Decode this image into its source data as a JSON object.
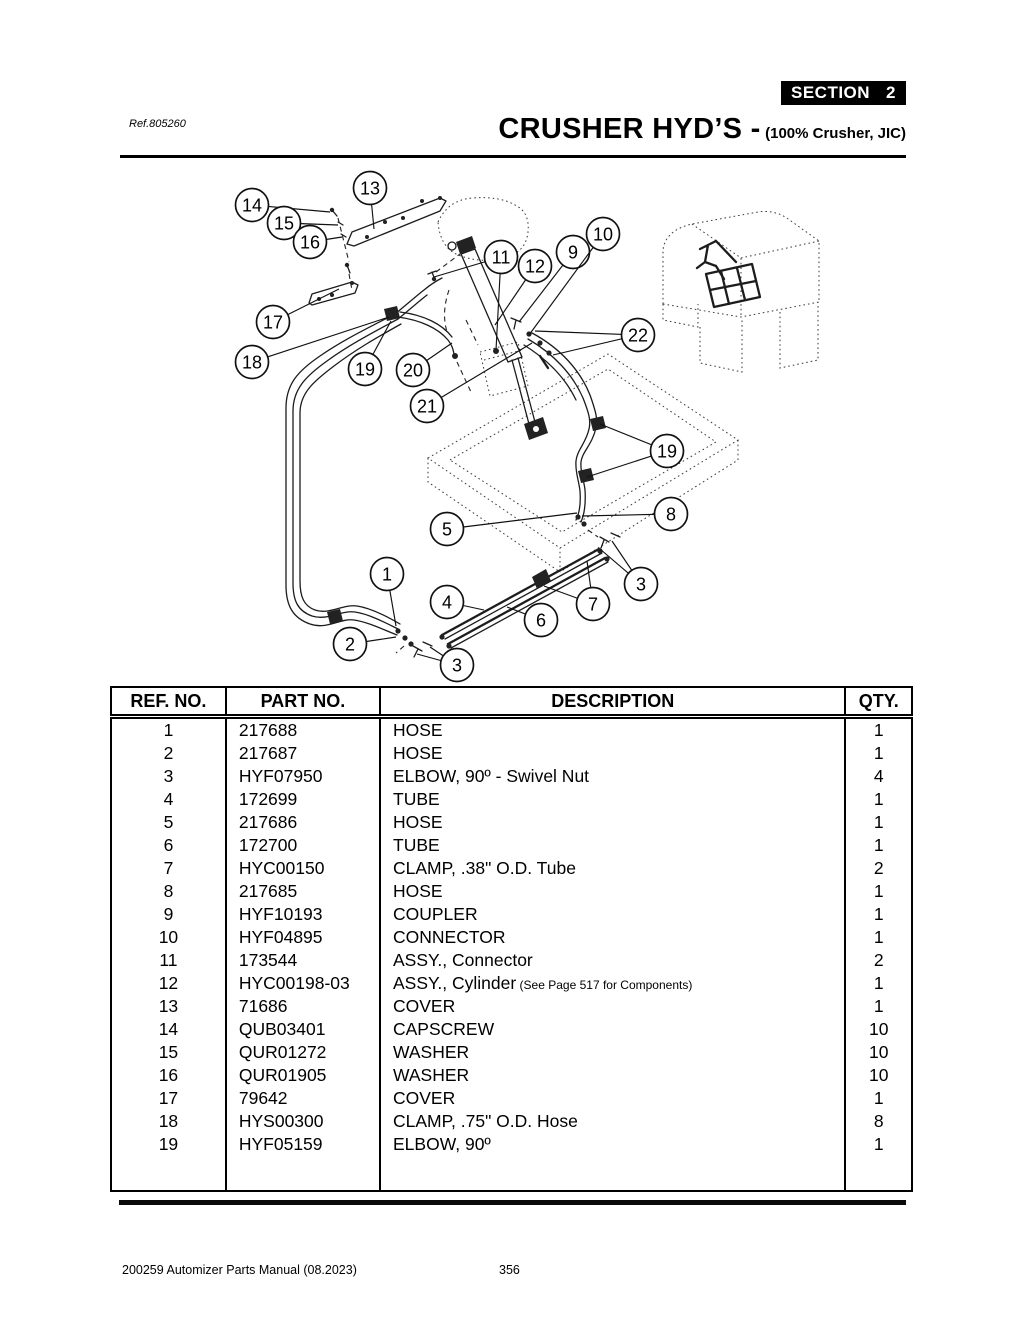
{
  "page": {
    "section_label": "SECTION",
    "section_number": "2",
    "ref_label": "Ref.805260",
    "title": "CRUSHER HYD’S -",
    "subtitle": "(100% Crusher, JIC)"
  },
  "table": {
    "headers": [
      "REF. NO.",
      "PART NO.",
      "DESCRIPTION",
      "QTY."
    ],
    "rows": [
      {
        "ref": "1",
        "part": "217688",
        "desc": "HOSE",
        "note": "",
        "qty": "1"
      },
      {
        "ref": "2",
        "part": "217687",
        "desc": "HOSE",
        "note": "",
        "qty": "1"
      },
      {
        "ref": "3",
        "part": "HYF07950",
        "desc": "ELBOW, 90º - Swivel Nut",
        "note": "",
        "qty": "4"
      },
      {
        "ref": "4",
        "part": "172699",
        "desc": "TUBE",
        "note": "",
        "qty": "1"
      },
      {
        "ref": "5",
        "part": "217686",
        "desc": "HOSE",
        "note": "",
        "qty": "1"
      },
      {
        "ref": "6",
        "part": "172700",
        "desc": "TUBE",
        "note": "",
        "qty": "1"
      },
      {
        "ref": "7",
        "part": "HYC00150",
        "desc": "CLAMP, .38\" O.D. Tube",
        "note": "",
        "qty": "2"
      },
      {
        "ref": "8",
        "part": "217685",
        "desc": "HOSE",
        "note": "",
        "qty": "1"
      },
      {
        "ref": "9",
        "part": "HYF10193",
        "desc": "COUPLER",
        "note": "",
        "qty": "1"
      },
      {
        "ref": "10",
        "part": "HYF04895",
        "desc": "CONNECTOR",
        "note": "",
        "qty": "1"
      },
      {
        "ref": "11",
        "part": "173544",
        "desc": "ASSY., Connector",
        "note": "",
        "qty": "2"
      },
      {
        "ref": "12",
        "part": "HYC00198-03",
        "desc": "ASSY., Cylinder",
        "note": "(See Page 517 for Components)",
        "qty": "1"
      },
      {
        "ref": "13",
        "part": "71686",
        "desc": "COVER",
        "note": "",
        "qty": "1"
      },
      {
        "ref": "14",
        "part": "QUB03401",
        "desc": "CAPSCREW",
        "note": "",
        "qty": "10"
      },
      {
        "ref": "15",
        "part": "QUR01272",
        "desc": "WASHER",
        "note": "",
        "qty": "10"
      },
      {
        "ref": "16",
        "part": "QUR01905",
        "desc": "WASHER",
        "note": "",
        "qty": "10"
      },
      {
        "ref": "17",
        "part": "79642",
        "desc": "COVER",
        "note": "",
        "qty": "1"
      },
      {
        "ref": "18",
        "part": "HYS00300",
        "desc": "CLAMP, .75\" O.D. Hose",
        "note": "",
        "qty": "8"
      },
      {
        "ref": "19",
        "part": "HYF05159",
        "desc": "ELBOW, 90º",
        "note": "",
        "qty": "1"
      }
    ]
  },
  "diagram": {
    "callouts": [
      {
        "label": "1",
        "x": 387,
        "y": 574,
        "leaders": [
          [
            396,
            626
          ]
        ]
      },
      {
        "label": "2",
        "x": 350,
        "y": 644,
        "leaders": [
          [
            396,
            637
          ]
        ]
      },
      {
        "label": "3",
        "x": 457,
        "y": 665,
        "leaders": [
          [
            430,
            647
          ],
          [
            417,
            654
          ]
        ]
      },
      {
        "label": "3",
        "x": 641,
        "y": 584,
        "leaders": [
          [
            612,
            541
          ],
          [
            600,
            549
          ]
        ]
      },
      {
        "label": "4",
        "x": 447,
        "y": 602,
        "leaders": [
          [
            484,
            610
          ]
        ]
      },
      {
        "label": "5",
        "x": 447,
        "y": 529,
        "leaders": [
          [
            577,
            513
          ]
        ]
      },
      {
        "label": "6",
        "x": 541,
        "y": 620,
        "leaders": [
          [
            507,
            607
          ]
        ]
      },
      {
        "label": "7",
        "x": 593,
        "y": 604,
        "leaders": [
          [
            544,
            586
          ],
          [
            587,
            561
          ]
        ]
      },
      {
        "label": "8",
        "x": 671,
        "y": 514,
        "leaders": [
          [
            582,
            516
          ]
        ]
      },
      {
        "label": "9",
        "x": 573,
        "y": 252,
        "leaders": [
          [
            519,
            322
          ]
        ]
      },
      {
        "label": "10",
        "x": 603,
        "y": 234,
        "leaders": [
          [
            529,
            335
          ]
        ]
      },
      {
        "label": "11",
        "x": 501,
        "y": 257,
        "leaders": [
          [
            434,
            277
          ],
          [
            496,
            350
          ]
        ]
      },
      {
        "label": "12",
        "x": 535,
        "y": 266,
        "leaders": [
          [
            495,
            325
          ]
        ]
      },
      {
        "label": "13",
        "x": 370,
        "y": 188,
        "leaders": [
          [
            374,
            229
          ]
        ]
      },
      {
        "label": "14",
        "x": 252,
        "y": 205,
        "leaders": [
          [
            330,
            212
          ]
        ]
      },
      {
        "label": "15",
        "x": 284,
        "y": 223,
        "leaders": [
          [
            338,
            225
          ]
        ]
      },
      {
        "label": "16",
        "x": 310,
        "y": 242,
        "leaders": [
          [
            342,
            237
          ]
        ]
      },
      {
        "label": "17",
        "x": 273,
        "y": 322,
        "leaders": [
          [
            339,
            289
          ]
        ]
      },
      {
        "label": "18",
        "x": 252,
        "y": 362,
        "leaders": [
          [
            389,
            317
          ]
        ]
      },
      {
        "label": "19",
        "x": 365,
        "y": 369,
        "leaders": [
          [
            391,
            321
          ]
        ]
      },
      {
        "label": "19",
        "x": 667,
        "y": 451,
        "leaders": [
          [
            600,
            424
          ],
          [
            587,
            477
          ]
        ]
      },
      {
        "label": "20",
        "x": 413,
        "y": 370,
        "leaders": [
          [
            452,
            343
          ]
        ]
      },
      {
        "label": "21",
        "x": 427,
        "y": 406,
        "leaders": [
          [
            532,
            343
          ]
        ]
      },
      {
        "label": "22",
        "x": 638,
        "y": 335,
        "leaders": [
          [
            535,
            331
          ],
          [
            553,
            355
          ]
        ]
      }
    ]
  },
  "footer": {
    "left": "200259 Automizer Parts Manual (08.2023)",
    "page_number": "356"
  }
}
